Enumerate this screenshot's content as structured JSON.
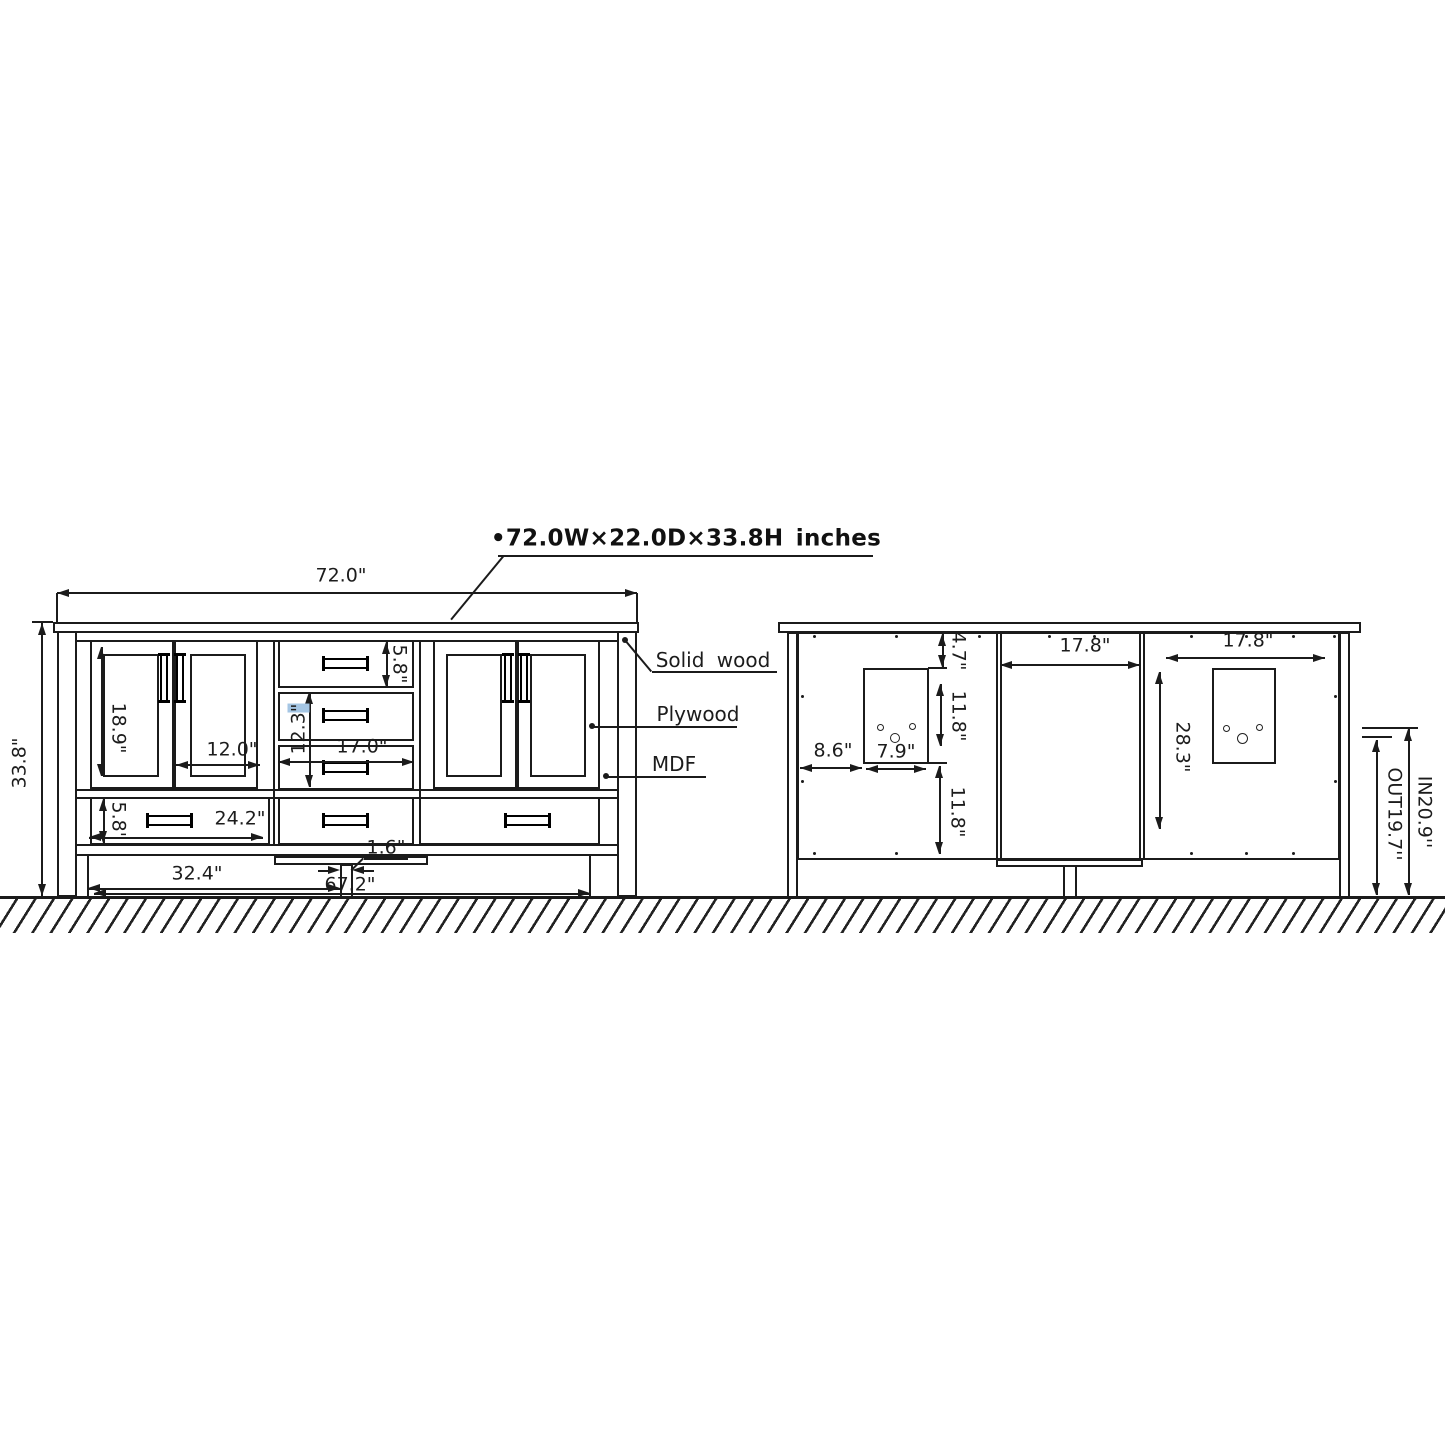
{
  "title": {
    "bullet": "•",
    "text": "72.0W×22.0D×33.8H inches"
  },
  "front_view": {
    "dims": {
      "overall_width": "72.0\"",
      "overall_height": "33.8\"",
      "door_height": "18.9\"",
      "door_width": "12.0\"",
      "top_drawer_height": "5.8\"",
      "middle_drawers_height": "12.3",
      "middle_drawers_height_unit": "\"",
      "middle_drawer_width": "17.0\"",
      "bottom_drawer_height": "5.8\"",
      "bottom_drawer_width": "24.2\"",
      "center_leg_width": "1.6\"",
      "left_section_width": "32.4\"",
      "base_width": "67.2\""
    },
    "materials": {
      "solid_wood": "Solid wood",
      "plywood": "Plywood",
      "mdf": "MDF"
    }
  },
  "back_view": {
    "dims": {
      "top_offset": "4.7\"",
      "middle_panel_width": "17.8\"",
      "right_panel_width": "17.8\"",
      "cutout_top_offset": "11.8\"",
      "cutout_bottom_offset": "11.8\"",
      "cutout_left_offset": "8.6\"",
      "cutout_width": "7.9\"",
      "panel_height": "28.3\"",
      "outlet_height": "OUT19.7''",
      "inlet_height": "IN20.9''"
    }
  }
}
